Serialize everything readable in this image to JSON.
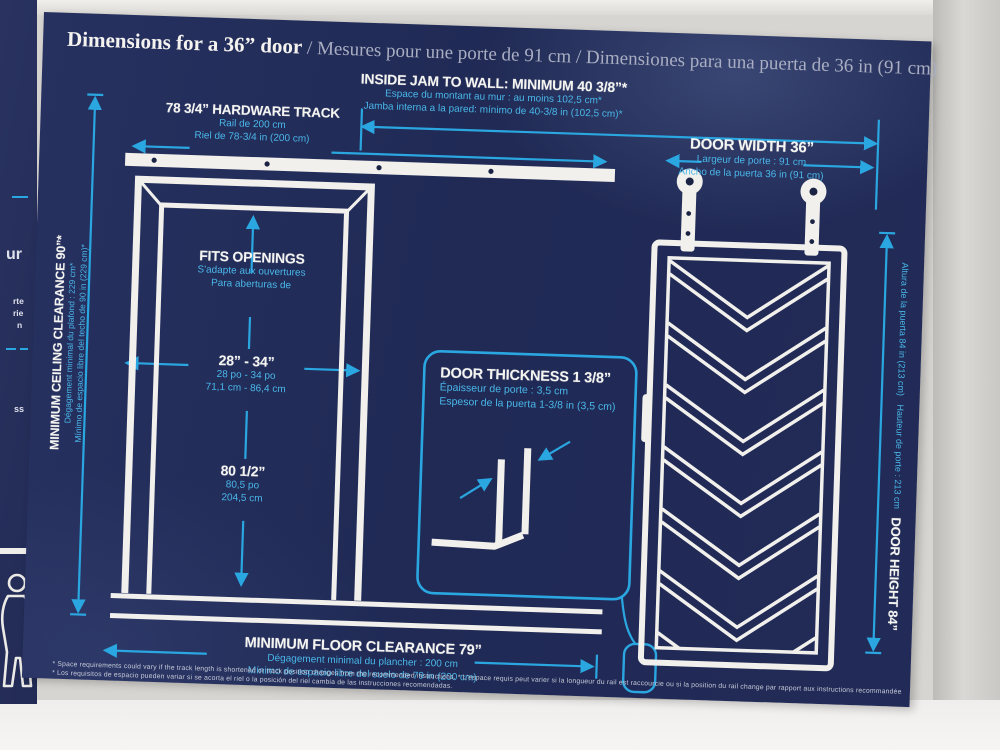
{
  "colors": {
    "panel_navy": "#222b57",
    "accent_cyan": "#2aa7e1",
    "line_white": "#f1f0ec"
  },
  "title": {
    "main": "Dimensions for a 36” door",
    "intl": " / Mesures pour une porte de 91 cm / Dimensiones para una puerta de 36 in (91 cm)"
  },
  "callouts": {
    "inside_jam": {
      "head": "INSIDE JAM TO WALL: MINIMUM 40 3/8”*",
      "fr": "Espace du montant au mur : au moins 102,5 cm*",
      "es": "Jamba interna a la pared: mínimo de 40-3/8 in (102,5 cm)*"
    },
    "hardware_track": {
      "head": "78 3/4” HARDWARE TRACK",
      "fr": "Rail de 200 cm",
      "es": "Riel de 78-3/4 in (200 cm)"
    },
    "door_width": {
      "head": "DOOR WIDTH 36”",
      "fr": "Largeur de porte : 91 cm",
      "es": "Ancho de la puerta 36 in (91 cm)"
    },
    "ceiling": {
      "head": "MINIMUM CEILING CLEARANCE 90”*",
      "fr": "Dégagement minimal du plafond : 229 cm*",
      "es": "Mínimo de espacio libre del techo de 90 in (229 cm)*"
    },
    "fits_openings": {
      "head": "FITS OPENINGS",
      "fr": "S'adapte aux ouvertures",
      "es": "Para aberturas de"
    },
    "opening_width": {
      "head": "28” - 34”",
      "fr": "28 po - 34 po",
      "es": "71,1 cm - 86,4 cm"
    },
    "opening_height": {
      "head": "80 1/2”",
      "fr": "80,5 po",
      "es": "204,5 cm"
    },
    "door_thickness": {
      "head": "DOOR THICKNESS 1 3/8”",
      "fr": "Épaisseur de porte : 3,5 cm",
      "es": "Espesor de la puerta 1-3/8 in (3,5 cm)"
    },
    "door_height": {
      "head": "DOOR HEIGHT 84”",
      "fr": "Hauteur de porte : 213 cm",
      "es": "Altura de la puerta 84 in (213 cm)"
    },
    "floor_clearance": {
      "head": "MINIMUM FLOOR CLEARANCE 79”",
      "fr": "Dégagement minimal du plancher : 200 cm",
      "es": "Mínimo de espacio libre del suelo de 79 in (200 cm)"
    }
  },
  "footnotes": {
    "line1": "* Space requirements could vary if the track length is shortened or track position changes from the recommended instructions. * L'espace requis peut varier si la longueur du rail est raccourcie ou si la position du rail change par rapport aux instructions recommandées.",
    "line2": "* Los requisitos de espacio pueden variar si se acorta el riel o la posición del riel cambia de las instrucciones recomendadas."
  },
  "side_panel": {
    "fragments": [
      "ur",
      "rte",
      "rie",
      "n",
      "ss"
    ]
  }
}
